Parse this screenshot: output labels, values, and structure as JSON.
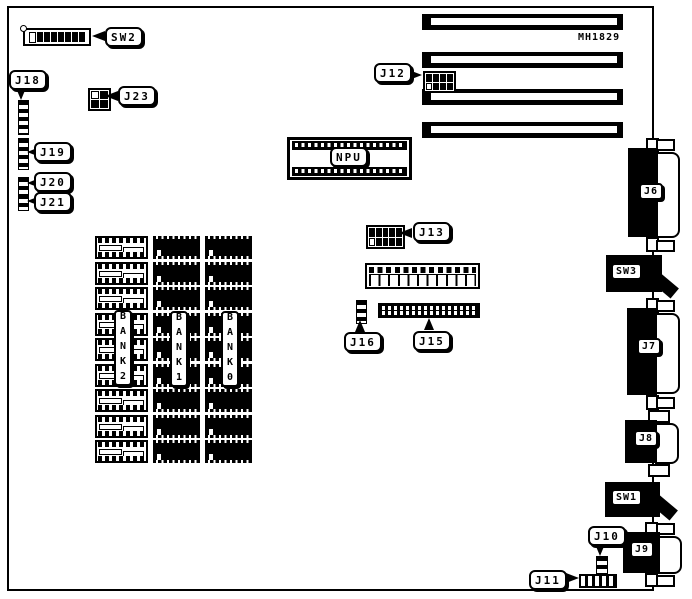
{
  "board": {
    "part_number": "MH1829"
  },
  "labels": {
    "sw2": "SW2",
    "j18": "J18",
    "j23": "J23",
    "j19": "J19",
    "j20": "J20",
    "j21": "J21",
    "j12": "J12",
    "npu": "NPU",
    "j13": "J13",
    "j16": "J16",
    "j15": "J15",
    "j6": "J6",
    "sw3": "SW3",
    "j7": "J7",
    "j8": "J8",
    "sw1": "SW1",
    "j10": "J10",
    "j9": "J9",
    "j11": "J11"
  },
  "memory": {
    "banks": [
      {
        "id": "bank2",
        "label": "BANK2",
        "type": "empty-sockets",
        "chip_count": 9
      },
      {
        "id": "bank1",
        "label": "BANK1",
        "type": "installed-chips",
        "chip_count": 9
      },
      {
        "id": "bank0",
        "label": "BANK0",
        "type": "installed-chips",
        "chip_count": 9
      }
    ]
  },
  "expansion_slots": {
    "count": 4
  }
}
